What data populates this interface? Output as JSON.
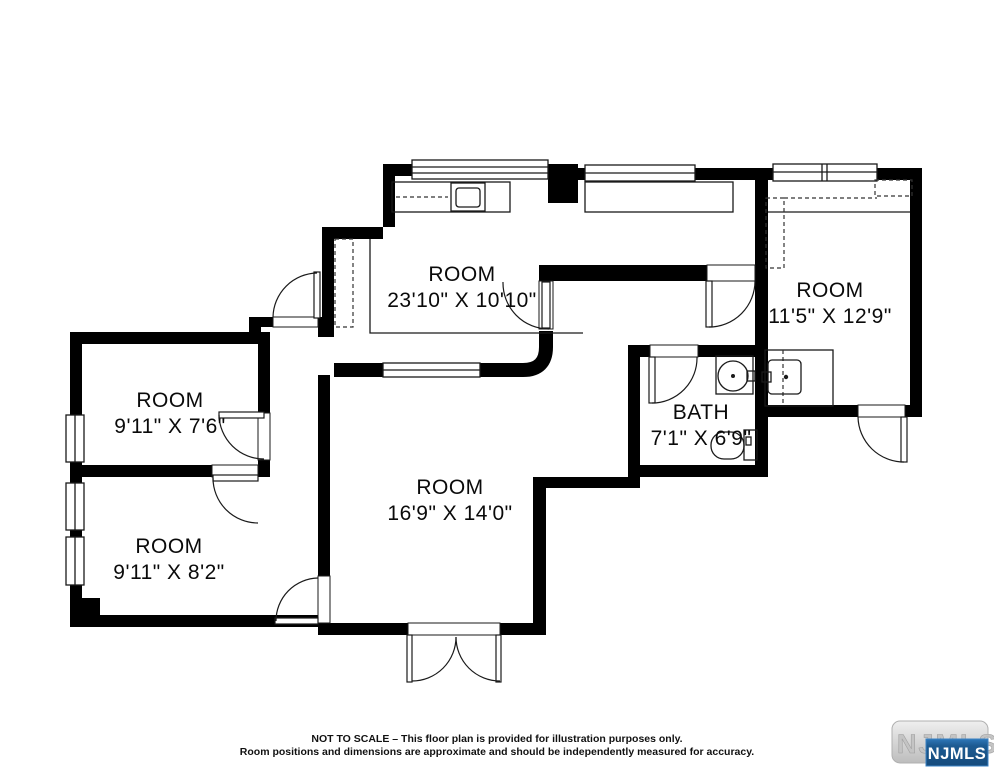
{
  "floorplan": {
    "rooms": [
      {
        "id": "top-room",
        "label": "ROOM",
        "dims": "23'10\" X 10'10\""
      },
      {
        "id": "right-room",
        "label": "ROOM",
        "dims": "11'5\" X 12'9\""
      },
      {
        "id": "bathroom",
        "label": "BATH",
        "dims": "7'1\" X 6'9\""
      },
      {
        "id": "center-room",
        "label": "ROOM",
        "dims": "16'9\" X 14'0\""
      },
      {
        "id": "upper-left-room",
        "label": "ROOM",
        "dims": "9'11\" X 7'6\""
      },
      {
        "id": "lower-left-room",
        "label": "ROOM",
        "dims": "9'11\" X 8'2\""
      }
    ],
    "disclaimer": {
      "line1": "NOT TO SCALE – This floor plan is provided for illustration purposes only.",
      "line2": "Room positions and dimensions are approximate and should be independently measured for accuracy."
    },
    "logo": {
      "background_text": "NJMLS",
      "badge_text": "NJMLS"
    },
    "colors": {
      "wall": "#000000",
      "canvas": "#ffffff",
      "logo_badge_blue": "#1d5b92",
      "logo_pill_grey": "#d8d8d8"
    }
  }
}
